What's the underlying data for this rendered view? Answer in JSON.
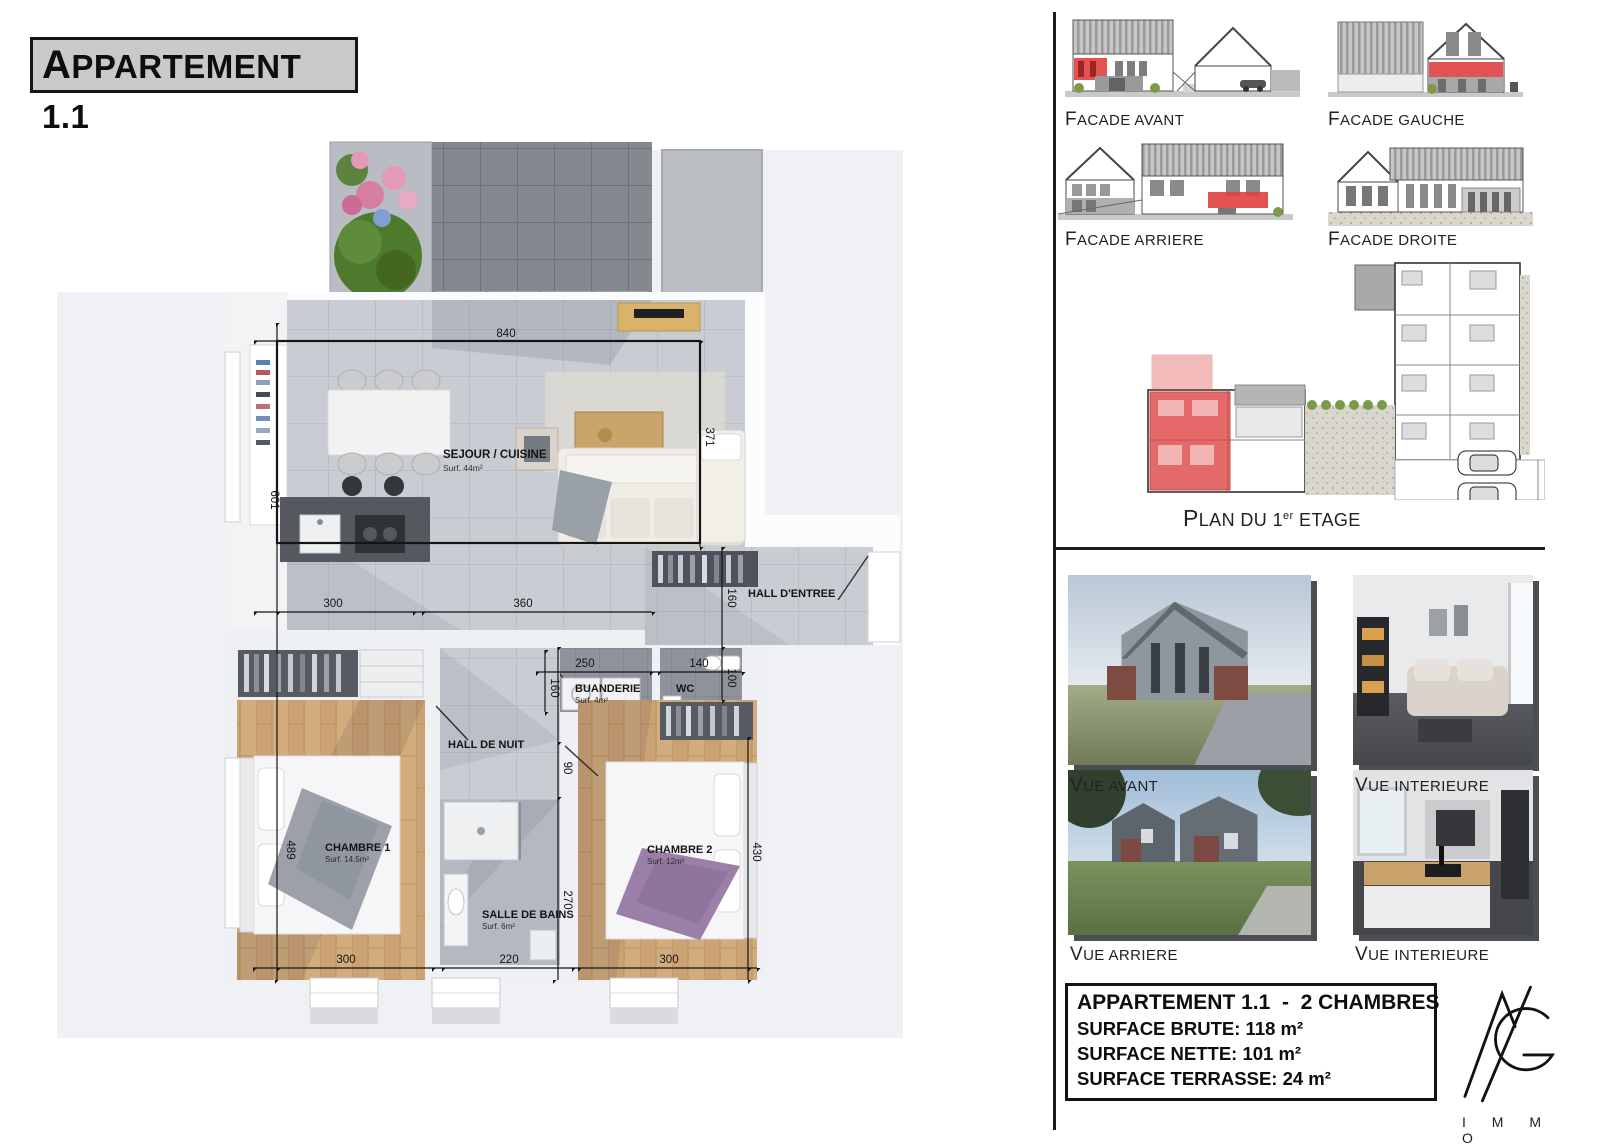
{
  "page": {
    "title": "APPARTEMENT 1.1"
  },
  "floor_plan": {
    "rooms": {
      "sejour": {
        "name": "SEJOUR / CUISINE",
        "surf": "Surf. 44m²"
      },
      "hall_entree": {
        "name": "HALL D'ENTREE"
      },
      "buanderie": {
        "name": "BUANDERIE",
        "surf": "Surf. 4m²"
      },
      "wc": {
        "name": "WC"
      },
      "hall_nuit": {
        "name": "HALL DE NUIT"
      },
      "chambre1": {
        "name": "CHAMBRE 1",
        "surf": "Surf. 14.5m²"
      },
      "salle_de_bains": {
        "name": "SALLE DE BAINS",
        "surf": "Surf. 6m²"
      },
      "chambre2": {
        "name": "CHAMBRE 2",
        "surf": "Surf. 12m²"
      }
    },
    "dims": {
      "w840": "840",
      "h601": "601",
      "h489": "489",
      "h371": "371",
      "h160_hall": "160",
      "w300a": "300",
      "w360": "360",
      "w250": "250",
      "h160_buand": "160",
      "w140": "140",
      "h100": "100",
      "h90": "90",
      "h270": "270",
      "h430": "430",
      "w300b": "300",
      "w220": "220",
      "w300c": "300"
    }
  },
  "elevations": {
    "avant": "FACADE AVANT",
    "gauche": "FACADE GAUCHE",
    "arriere": "FACADE ARRIERE",
    "droite": "FACADE DROITE"
  },
  "plan_overview": {
    "prefix": "PLAN DU 1",
    "sup": "er",
    "suffix": " ETAGE"
  },
  "photos": {
    "avant": "VUE AVANT",
    "interieure1": "VUE INTERIEURE",
    "arriere": "VUE ARRIERE",
    "interieure2": "VUE INTERIEURE"
  },
  "summary": {
    "title": "APPARTEMENT 1.1  -  2 CHAMBRES",
    "brute": "SURFACE BRUTE: 118 m²",
    "nette": "SURFACE NETTE: 101 m²",
    "terrasse": "SURFACE TERRASSE: 24 m²"
  },
  "brand": {
    "name": "I M M O"
  },
  "colors": {
    "highlight_red": "#e03c3c",
    "plan_wood": "#d2ac7c",
    "plan_tile": "#c9ccd3",
    "shadow": "#4b4e53"
  }
}
